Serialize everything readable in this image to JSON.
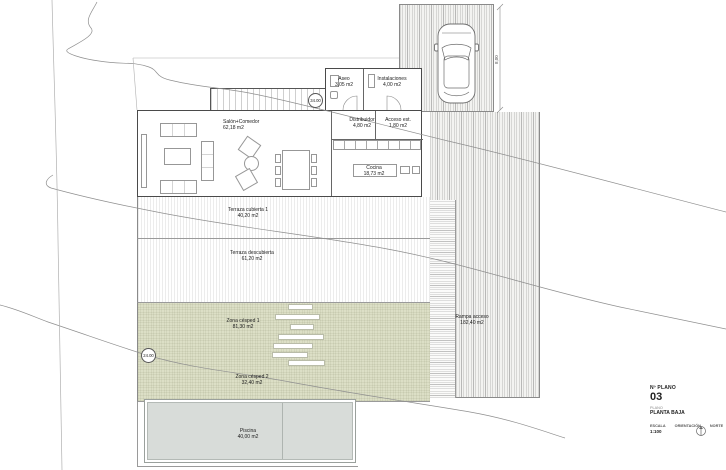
{
  "rooms": [
    {
      "name": "Aseo",
      "area": "3,05 m2"
    },
    {
      "name": "Instalaciones",
      "area": "4,00 m2"
    },
    {
      "name": "Salón+Comedor",
      "area": "62,18 m2"
    },
    {
      "name": "Distribuidor",
      "area": "4,80 m2"
    },
    {
      "name": "Acceso est.",
      "area": "1,80 m2"
    },
    {
      "name": "Cocina",
      "area": "18,73 m2"
    }
  ],
  "outdoor": [
    {
      "name": "Terraza cubierta 1",
      "area": "40,20 m2"
    },
    {
      "name": "Terraza descubierta",
      "area": "61,20 m2"
    },
    {
      "name": "Zona césped 1",
      "area": "81,30 m2"
    },
    {
      "name": "Zona césped 2",
      "area": "32,40 m2"
    },
    {
      "name": "Piscina",
      "area": "40,00 m2"
    },
    {
      "name": "Rampa acceso",
      "area": "182,40 m2"
    }
  ],
  "levels": {
    "stair_level": "34.00",
    "garden_level": "24.00"
  },
  "dimensions": {
    "parking_width": "8,00"
  },
  "title_block": {
    "no_plano_label": "Nº PLANO",
    "plan_number": "03",
    "field_label": "PLANO",
    "plan_name": "PLANTA BAJA",
    "scale_label": "ESCALA",
    "scale_value": "1:100",
    "orientation_label": "ORIENTACIÓN",
    "north_label": "NORTE"
  },
  "colors": {
    "grass": "#dcdfc6",
    "pool": "#d8dcd9",
    "wall": "#4a4a4a",
    "contour": "#8f8f8f"
  }
}
